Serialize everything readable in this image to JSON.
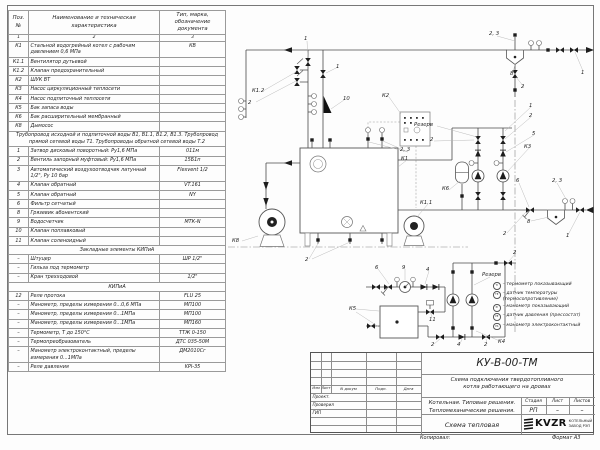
{
  "sheet": {
    "copied_label": "Копировал:",
    "format_label": "Формат А3"
  },
  "spec_table": {
    "header": {
      "pos": "Поз. №",
      "name": "Наименование и техническая характеристика",
      "type": "Тип, марка, обозначение документа"
    },
    "col_numbers": [
      "1",
      "2",
      "3"
    ],
    "rows": [
      {
        "pos": "К1",
        "name": "Стальной водогрейный котел с рабочим давлением 0,6 МПа",
        "type": "КВ"
      },
      {
        "pos": "К1.1",
        "name": "Вентилятор дутьевой",
        "type": ""
      },
      {
        "pos": "К1.2",
        "name": "Клапан предохранительный",
        "type": ""
      },
      {
        "pos": "К2",
        "name": "ШУК ВТ",
        "type": ""
      },
      {
        "pos": "К3",
        "name": "Насос циркуляционный теплосети",
        "type": ""
      },
      {
        "pos": "К4",
        "name": "Насос подпиточный теплосети",
        "type": ""
      },
      {
        "pos": "К5",
        "name": "Бак запаса воды",
        "type": ""
      },
      {
        "pos": "К6",
        "name": "Бак расширительный мембранный",
        "type": ""
      },
      {
        "pos": "К8",
        "name": "Дымосос",
        "type": ""
      },
      {
        "section": "Трубопровод исходной и подпиточной воды В1, В1.1, В1.2, В1.3. Трубопровод прямой сетевой воды Т1. Трубопроводы обратной сетевой воды Т.2"
      },
      {
        "pos": "1",
        "name": "Затвор дисковый поворотный: Ру1,6 МПа",
        "type": "011м"
      },
      {
        "pos": "2",
        "name": "Вентиль запорный муфтовый: Ру1,6 МПа",
        "type": "15Б1п"
      },
      {
        "pos": "3",
        "name": "Автоматический воздухоотводчик латунный 1/2\", Ру 10 бар",
        "type": "Flexvent 1/2"
      },
      {
        "pos": "4",
        "name": "Клапан обратный",
        "type": "VT.161"
      },
      {
        "pos": "5",
        "name": "Клапан обратный",
        "type": "NY"
      },
      {
        "pos": "6",
        "name": "Фильтр сетчатый",
        "type": ""
      },
      {
        "pos": "8",
        "name": "Грязевик абонентский",
        "type": ""
      },
      {
        "pos": "9",
        "name": "Водосчетчик",
        "type": "МТК-N"
      },
      {
        "pos": "10",
        "name": "Клапан поплавковый",
        "type": ""
      },
      {
        "pos": "11",
        "name": "Клапан соленоидный",
        "type": ""
      },
      {
        "section": "Закладные элементы КИПиА"
      },
      {
        "pos": "–",
        "name": "Штуцер",
        "type": "ШР 1/2\""
      },
      {
        "pos": "–",
        "name": "Гильза под термометр",
        "type": ""
      },
      {
        "pos": "–",
        "name": "Кран трехходовой",
        "type": "1/2\""
      },
      {
        "section": "КИПиА"
      },
      {
        "pos": "12",
        "name": "Реле протока",
        "type": "FLU 25"
      },
      {
        "pos": "–",
        "name": "Манометр, пределы измерения 0...0,6 МПа",
        "type": "МП100"
      },
      {
        "pos": "–",
        "name": "Манометр, пределы измерения 0...1МПа",
        "type": "МП100"
      },
      {
        "pos": "–",
        "name": "Манометр, пределы измерения 0...1МПа",
        "type": "МП160"
      },
      {
        "pos": "–",
        "name": "Термометр, Т до 150°С",
        "type": "ТТЖ 0-150"
      },
      {
        "pos": "–",
        "name": "Термопреобразователь",
        "type": "ДТС 035-50М"
      },
      {
        "pos": "–",
        "name": "Манометр электроконтактный, пределы измерения 0...1МПа",
        "type": "ДМ2010Сг"
      },
      {
        "pos": "–",
        "name": "Реле давления",
        "type": "KPI-35"
      }
    ]
  },
  "legend": {
    "items": [
      {
        "tag": "TI",
        "text": "– термометр показывающий"
      },
      {
        "tag": "TE",
        "text": "– датчик температуры",
        "text2": "(термосопротивление)"
      },
      {
        "tag": "PI",
        "text": "– манометр показывающий"
      },
      {
        "tag": "PE",
        "text": "– датчик давления (прессостат)"
      },
      {
        "tag": "PS",
        "text": "– манометр электроконтактный"
      }
    ]
  },
  "schematic_labels": [
    {
      "text": "1",
      "x": 304,
      "y": 36
    },
    {
      "text": "1",
      "x": 336,
      "y": 64
    },
    {
      "text": "К1.2",
      "x": 252,
      "y": 88
    },
    {
      "text": "2",
      "x": 248,
      "y": 100
    },
    {
      "text": "10",
      "x": 343,
      "y": 96
    },
    {
      "text": "К2",
      "x": 382,
      "y": 93
    },
    {
      "text": "2, 3",
      "x": 489,
      "y": 31
    },
    {
      "text": "1",
      "x": 581,
      "y": 70
    },
    {
      "text": "8",
      "x": 510,
      "y": 71
    },
    {
      "text": "2",
      "x": 521,
      "y": 84
    },
    {
      "text": "Резерв",
      "x": 414,
      "y": 122
    },
    {
      "text": "2",
      "x": 430,
      "y": 137
    },
    {
      "text": "1",
      "x": 529,
      "y": 103
    },
    {
      "text": "2",
      "x": 529,
      "y": 113
    },
    {
      "text": "5",
      "x": 532,
      "y": 131
    },
    {
      "text": "К3",
      "x": 524,
      "y": 144
    },
    {
      "text": "2, 3",
      "x": 400,
      "y": 147
    },
    {
      "text": "К1",
      "x": 401,
      "y": 156
    },
    {
      "text": "К6",
      "x": 442,
      "y": 186
    },
    {
      "text": "К1.1",
      "x": 420,
      "y": 200
    },
    {
      "text": "К8",
      "x": 232,
      "y": 238
    },
    {
      "text": "2",
      "x": 305,
      "y": 257
    },
    {
      "text": "6",
      "x": 375,
      "y": 265
    },
    {
      "text": "9",
      "x": 402,
      "y": 265
    },
    {
      "text": "4",
      "x": 426,
      "y": 267
    },
    {
      "text": "Резерв",
      "x": 482,
      "y": 272
    },
    {
      "text": "2",
      "x": 513,
      "y": 250
    },
    {
      "text": "2, 3",
      "x": 552,
      "y": 178
    },
    {
      "text": "6",
      "x": 516,
      "y": 178
    },
    {
      "text": "8",
      "x": 527,
      "y": 219
    },
    {
      "text": "1",
      "x": 566,
      "y": 233
    },
    {
      "text": "2",
      "x": 503,
      "y": 231
    },
    {
      "text": "К5",
      "x": 349,
      "y": 306
    },
    {
      "text": "11",
      "x": 429,
      "y": 317
    },
    {
      "text": "2",
      "x": 431,
      "y": 342
    },
    {
      "text": "4",
      "x": 457,
      "y": 342
    },
    {
      "text": "2",
      "x": 484,
      "y": 342
    },
    {
      "text": "К4",
      "x": 498,
      "y": 339
    }
  ],
  "title_block": {
    "doc_code": "КУ-В-00-ТМ",
    "doc_title_line1": "Схема подключения твердотопливного",
    "doc_title_line2": "котла работающего на дровах",
    "project_line1": "Котельная. Типовые решения.",
    "project_line2": "Тепломеханические решения.",
    "stage_label": "Стадия",
    "sheet_label": "Лист",
    "sheets_label": "Листов",
    "stage": "РП",
    "sheet": "–",
    "sheets": "–",
    "drawing_name": "Схема тепловая",
    "company_logo": "KVZR",
    "company_name_line1": "КОТЕЛЬНЫЙ",
    "company_name_line2": "ЗАВОД РЭП",
    "sig_header": [
      "Изм",
      "Лист",
      "N докум",
      "Подп.",
      "Дата"
    ],
    "sig_roles": [
      "Проект.",
      "Проверил",
      "ГИП"
    ]
  }
}
